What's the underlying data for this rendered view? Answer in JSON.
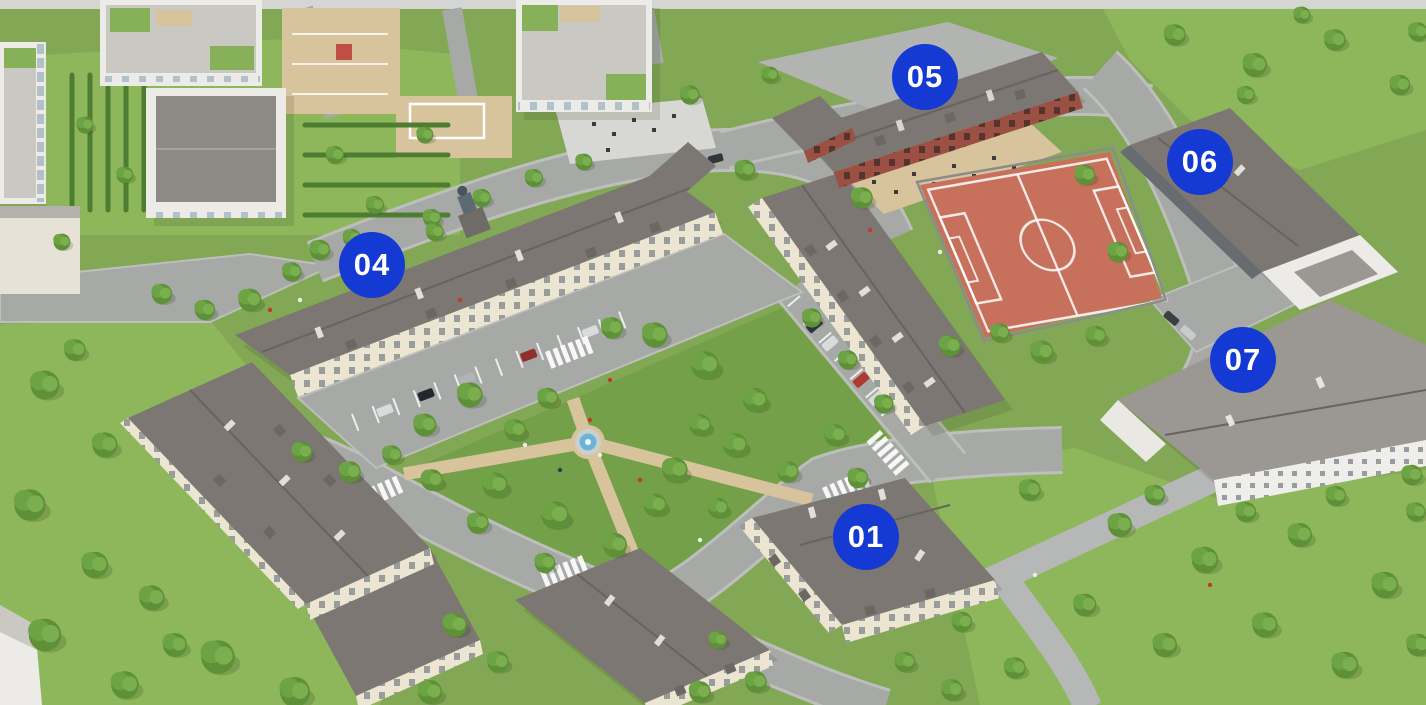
{
  "view": {
    "width": 1426,
    "height": 705
  },
  "markers": [
    {
      "label": "01",
      "x_pct": 60.73,
      "y_pct": 76.17
    },
    {
      "label": "04",
      "x_pct": 26.09,
      "y_pct": 37.59
    },
    {
      "label": "05",
      "x_pct": 64.87,
      "y_pct": 10.92
    },
    {
      "label": "06",
      "x_pct": 84.15,
      "y_pct": 22.98
    },
    {
      "label": "07",
      "x_pct": 87.17,
      "y_pct": 51.06
    }
  ],
  "marker_style": {
    "diameter_px": 66
  },
  "colors": {
    "marker_bg": "#1539d3",
    "marker_text": "#ffffff",
    "grass": "#83a855",
    "grass_light": "#8eb75c",
    "park": "#73a048",
    "road": "#a6a9a6",
    "curb": "#bcbfbc",
    "road_light": "#d5d5d3",
    "plaza": "#b1b4b1",
    "walk_gray": "#b5b8b6",
    "path_tan": "#d8c49c",
    "field": "#c7705b",
    "roof_dark": "#7c7772",
    "roof_light": "#9b9792",
    "wall_cream": "#ebe5d1",
    "brick": "#9c5044",
    "modern_white": "#ecebe7",
    "modern_roof": "#cac8c3",
    "hedge": "#4d7d31",
    "water": "#6db3d8",
    "fence": "#8a8d8a",
    "tree_dark": "#5e9038",
    "tree_mid": "#6ca344",
    "tree_light": "#7bae4e"
  }
}
